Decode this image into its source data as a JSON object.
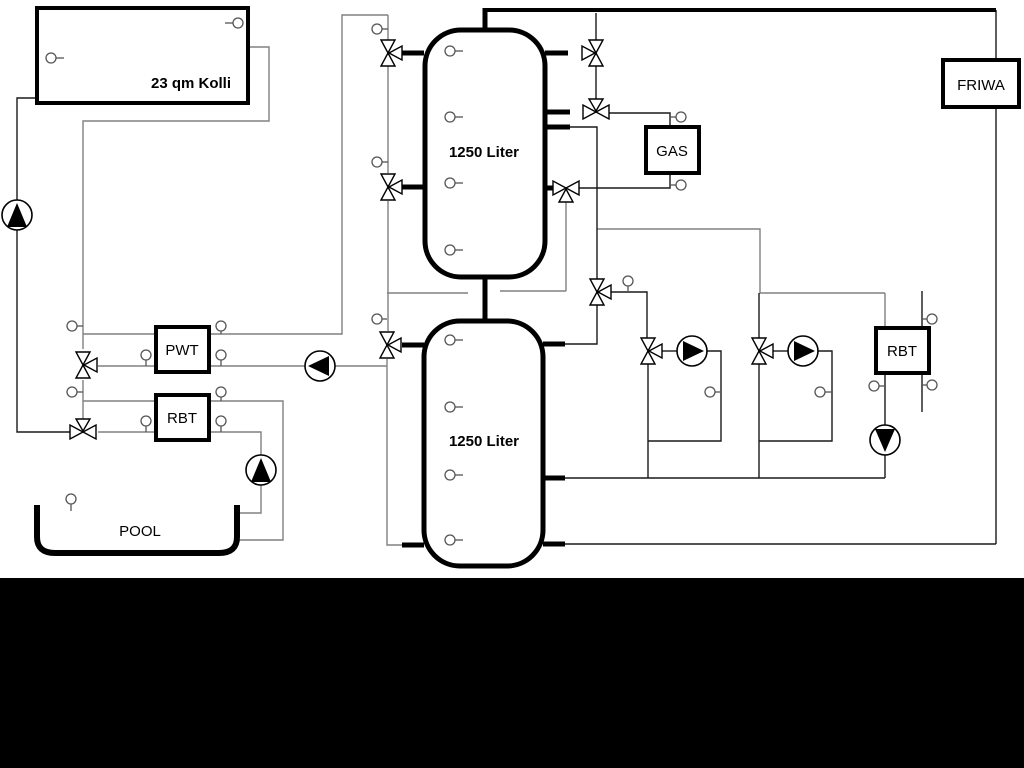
{
  "diagram": {
    "labels": {
      "collector": "23 qm Kolli",
      "upper_tank": "1250 Liter",
      "lower_tank": "1250 Liter",
      "pwt": "PWT",
      "rbt_left": "RBT",
      "pool": "POOL",
      "gas": "GAS",
      "friwa": "FRIWA",
      "rbt_right": "RBT"
    },
    "colors": {
      "background": "#ffffff",
      "line_primary": "#000000",
      "line_secondary": "#808080",
      "bottom_band": "#000000"
    }
  }
}
